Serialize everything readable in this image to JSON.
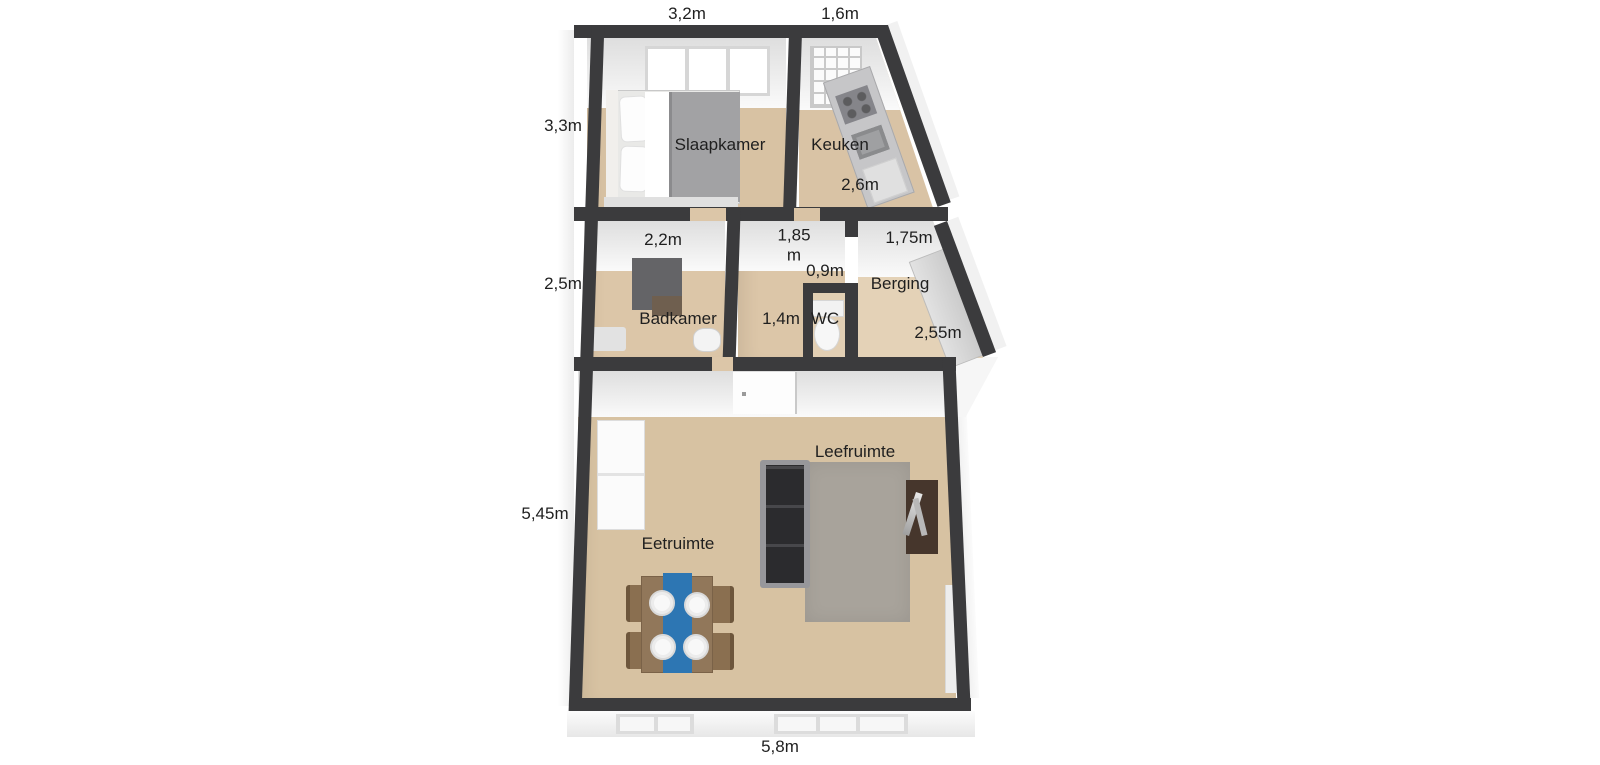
{
  "floor_plan": {
    "rooms": {
      "slaapkamer": "Slaapkamer",
      "keuken": "Keuken",
      "badkamer": "Badkamer",
      "wc": "WC",
      "berging": "Berging",
      "leefruimte": "Leefruimte",
      "eetruimte": "Eetruimte"
    },
    "dimensions": {
      "slaapkamer_width": "3,2m",
      "keuken_width": "1,6m",
      "slaapkamer_depth": "3,3m",
      "badkamer_depth": "2,5m",
      "leefruimte_depth": "5,45m",
      "keuken_depth": "2,6m",
      "badkamer_width": "2,2m",
      "hal_width": "1,85\nm",
      "hal_niche": "0,9m",
      "berging_width": "1,75m",
      "hal_depth": "1,4m",
      "berging_depth": "2,55m",
      "leefruimte_width": "5,8m"
    },
    "colors": {
      "wall": "#3b3b3d",
      "floor_tan": "#d7c2a2",
      "floor_light": "#e4d2b7",
      "rug": "#a8a39b",
      "table_runner": "#2d76b3",
      "sofa": "#2b2b2e",
      "tv_unit": "#46362c",
      "wood": "#91775a"
    }
  }
}
